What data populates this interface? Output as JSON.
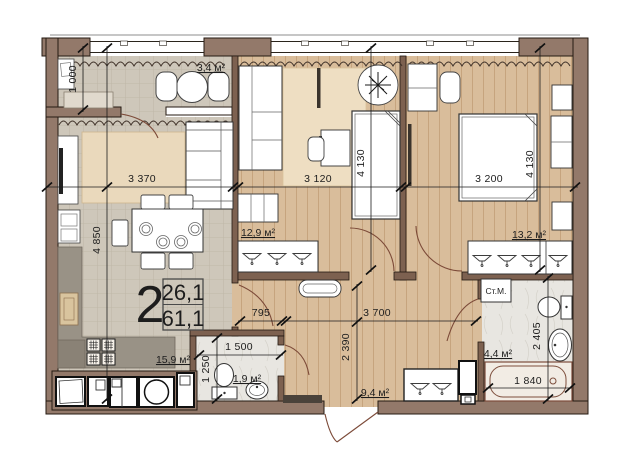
{
  "info_box": {
    "rooms_count": "2",
    "upper": "26,1",
    "lower": "61,1"
  },
  "rooms": {
    "balcony": "3,4 м²",
    "bedroom1": "12,9 м²",
    "bedroom2": "13,2 м²",
    "kitchen_living": "15,9 м²",
    "wc": "1,9 м²",
    "hallway": "9,4 м²",
    "bathroom": "4,4 м²"
  },
  "labels": {
    "washing_machine": "Ст.М."
  },
  "dimensions": {
    "balcony_depth": "1 000",
    "living_width": "3 370",
    "living_depth": "4 850",
    "bedroom1_width": "3 120",
    "bedroom1_depth": "4 130",
    "bedroom2_width": "3 200",
    "bedroom2_depth": "4 130",
    "hall_stub_width": "795",
    "hall_width": "3 700",
    "hall_depth": "2 390",
    "wc_width": "1 500",
    "wc_depth": "1 250",
    "bath_depth": "2 405",
    "bath_width": "1 840"
  },
  "colors": {
    "exterior_wall": "#93796a",
    "interior_wall": "#7d6150",
    "wood_floor": "#d9bd9b",
    "tile_floor": "#cec7ba",
    "wet_floor": "#e8e6e1",
    "carpet": "#ead9bc",
    "dim_line": "#1c1c1c",
    "door_arc": "#7c4a38"
  }
}
